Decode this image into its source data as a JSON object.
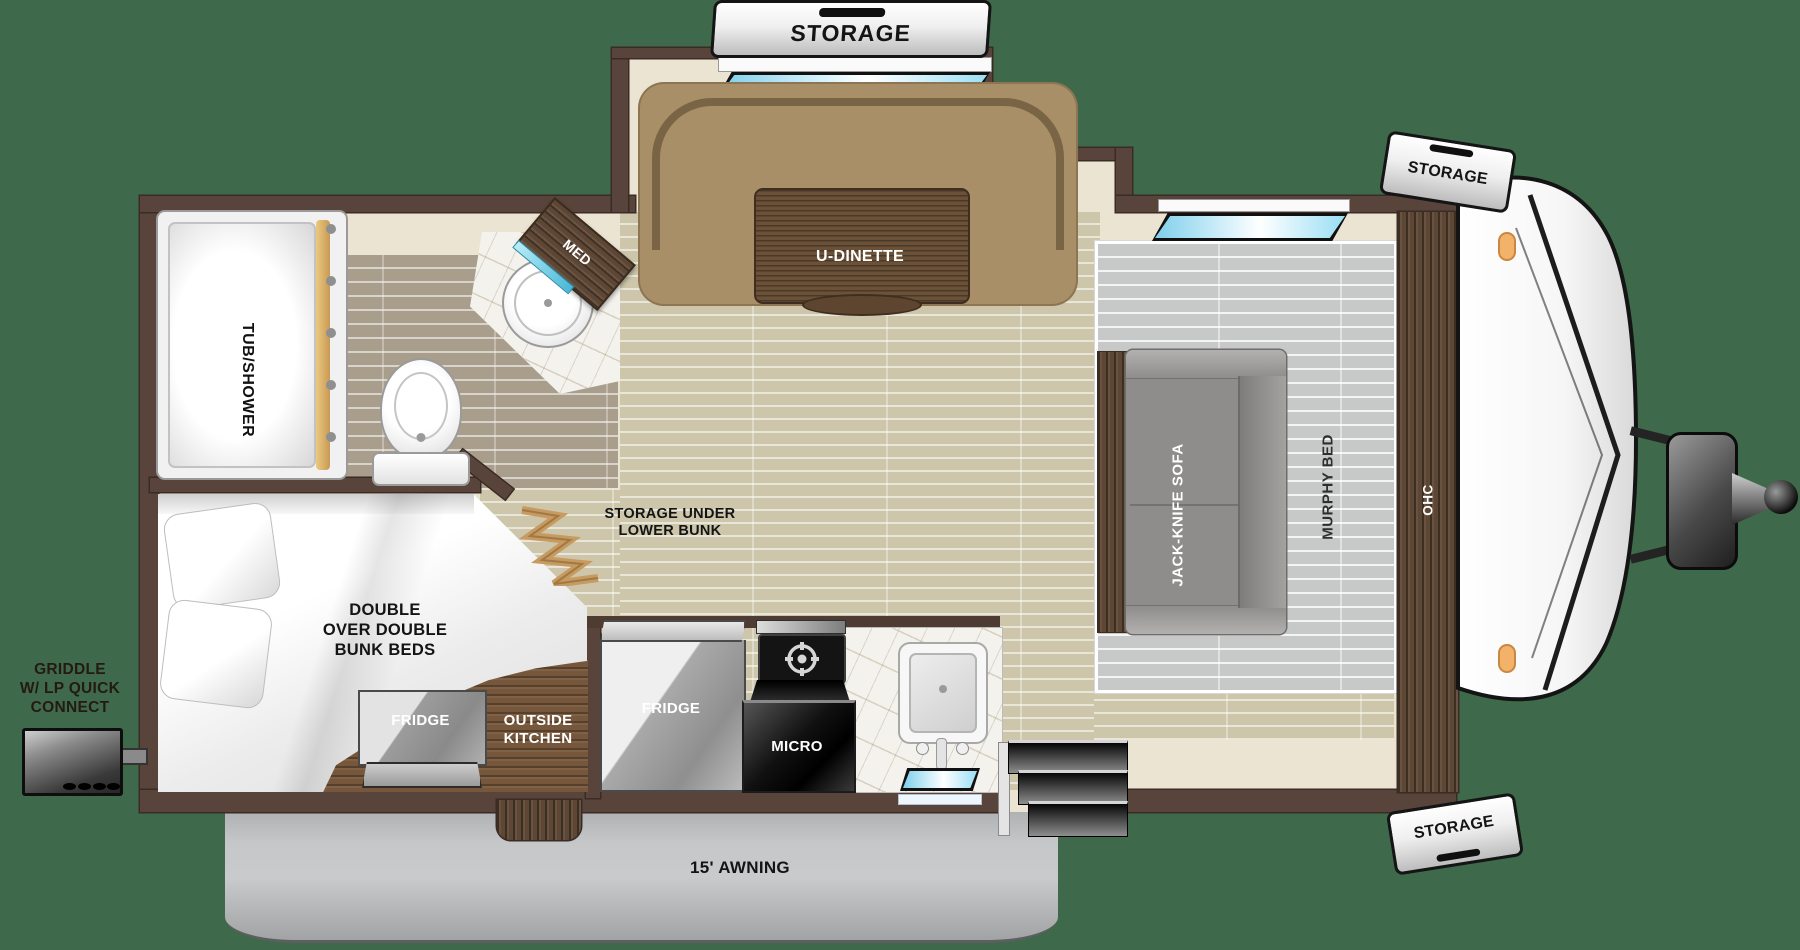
{
  "colors": {
    "background": "#3e6a4b",
    "wall": "#58443a",
    "window_blue": "#8fd9f2",
    "accent_teal": "#5fc3de",
    "marker_light": "#f2b269"
  },
  "slideout": {
    "storage_tag": "STORAGE",
    "dinette_label": "U-DINETTE"
  },
  "front_cap": {
    "storage_tag_top": "STORAGE",
    "storage_tag_bottom": "STORAGE"
  },
  "living": {
    "sofa_label": "JACK-KNIFE SOFA",
    "murphy_label": "MURPHY BED",
    "ohc_label": "OHC",
    "storage_under_lines": [
      "STORAGE UNDER",
      "LOWER BUNK"
    ]
  },
  "bathroom": {
    "tub_label": "TUB/SHOWER",
    "med_label": "MED"
  },
  "bunk_room": {
    "bed_lines": [
      "DOUBLE",
      "OVER DOUBLE",
      "BUNK BEDS"
    ],
    "outside_fridge_label": "FRIDGE",
    "outside_kitchen_lines": [
      "OUTSIDE",
      "KITCHEN"
    ]
  },
  "kitchen": {
    "fridge_label": "FRIDGE",
    "micro_label": "MICRO"
  },
  "exterior": {
    "griddle_lines": [
      "GRIDDLE",
      "W/ LP QUICK",
      "CONNECT"
    ],
    "awning_label": "15' AWNING"
  }
}
